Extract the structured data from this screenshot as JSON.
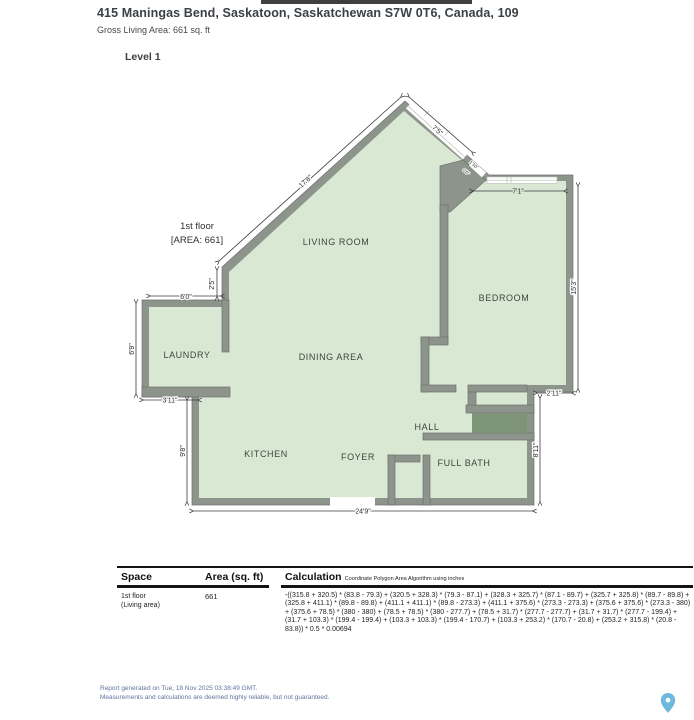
{
  "header": {
    "address": "415 Maningas Bend, Saskatoon, Saskatchewan S7W 0T6, Canada, 109",
    "gross_living_area": "Gross Living Area: 661 sq. ft",
    "level": "Level 1"
  },
  "plan": {
    "floor_label_line1": "1st floor",
    "floor_label_line2": "[AREA: 661]",
    "rooms": {
      "living": "LIVING ROOM",
      "bedroom": "BEDROOM",
      "laundry": "LAUNDRY",
      "dining": "DINING AREA",
      "kitchen": "KITCHEN",
      "foyer": "FOYER",
      "hall": "HALL",
      "bath": "FULL BATH"
    },
    "dimensions": {
      "diag_long": "17'8\"",
      "diag_short": "7'5\"",
      "diag_tiny_a": "1'10\"",
      "diag_tiny_b": "0'6\"",
      "bedroom_top": "7'1\"",
      "bedroom_right": "15'3\"",
      "step_right": "2'11\"",
      "bath_right": "8'11\"",
      "bottom": "24'9\"",
      "kitchen_left": "9'8\"",
      "laundry_bottom": "3'11\"",
      "laundry_left": "6'9\"",
      "laundry_top": "6'0\"",
      "waist": "2'5\""
    },
    "colors": {
      "floor": "#d9e8d3",
      "wall": "#8d948c",
      "closet": "#7e9478",
      "pin_blue": "#6cb9dd"
    }
  },
  "table": {
    "col_space": "Space",
    "col_area": "Area (sq. ft)",
    "col_calc": "Calculation",
    "calc_note": "Coordinate Polygon Area Algorithm using inches",
    "row1": {
      "space_line1": "1st floor",
      "space_line2": "(Living area)",
      "area": "661",
      "calculation": "-((315.8 + 320.5) * (83.8 - 79.3) + (320.5 + 328.3) * (79.3 - 87.1) + (328.3 + 325.7) * (87.1 - 89.7) + (325.7 + 325.8) * (89.7 - 89.8) + (325.8 + 411.1) * (89.8 - 89.8) + (411.1 + 411.1) * (89.8 - 273.3) + (411.1 + 375.6) * (273.3 - 273.3) + (375.6 + 375.6) * (273.3 - 380) + (375.6 + 78.5) * (380 - 380) + (78.5 + 78.5) * (380 - 277.7) + (78.5 + 31.7) * (277.7 - 277.7) + (31.7 + 31.7) * (277.7 - 199.4) + (31.7 + 103.3) * (199.4 - 199.4) + (103.3 + 103.3) * (199.4 - 170.7) + (103.3 + 253.2) * (170.7 - 20.8) + (253.2 + 315.8) * (20.8 - 83.8)) * 0.5 * 0.00694"
    }
  },
  "footer": {
    "generated": "Report generated on Tue, 18 Nov 2025 03:38:49 GMT.",
    "disclaimer": "Measurements and calculations are deemed highly reliable, but not guaranteed."
  }
}
